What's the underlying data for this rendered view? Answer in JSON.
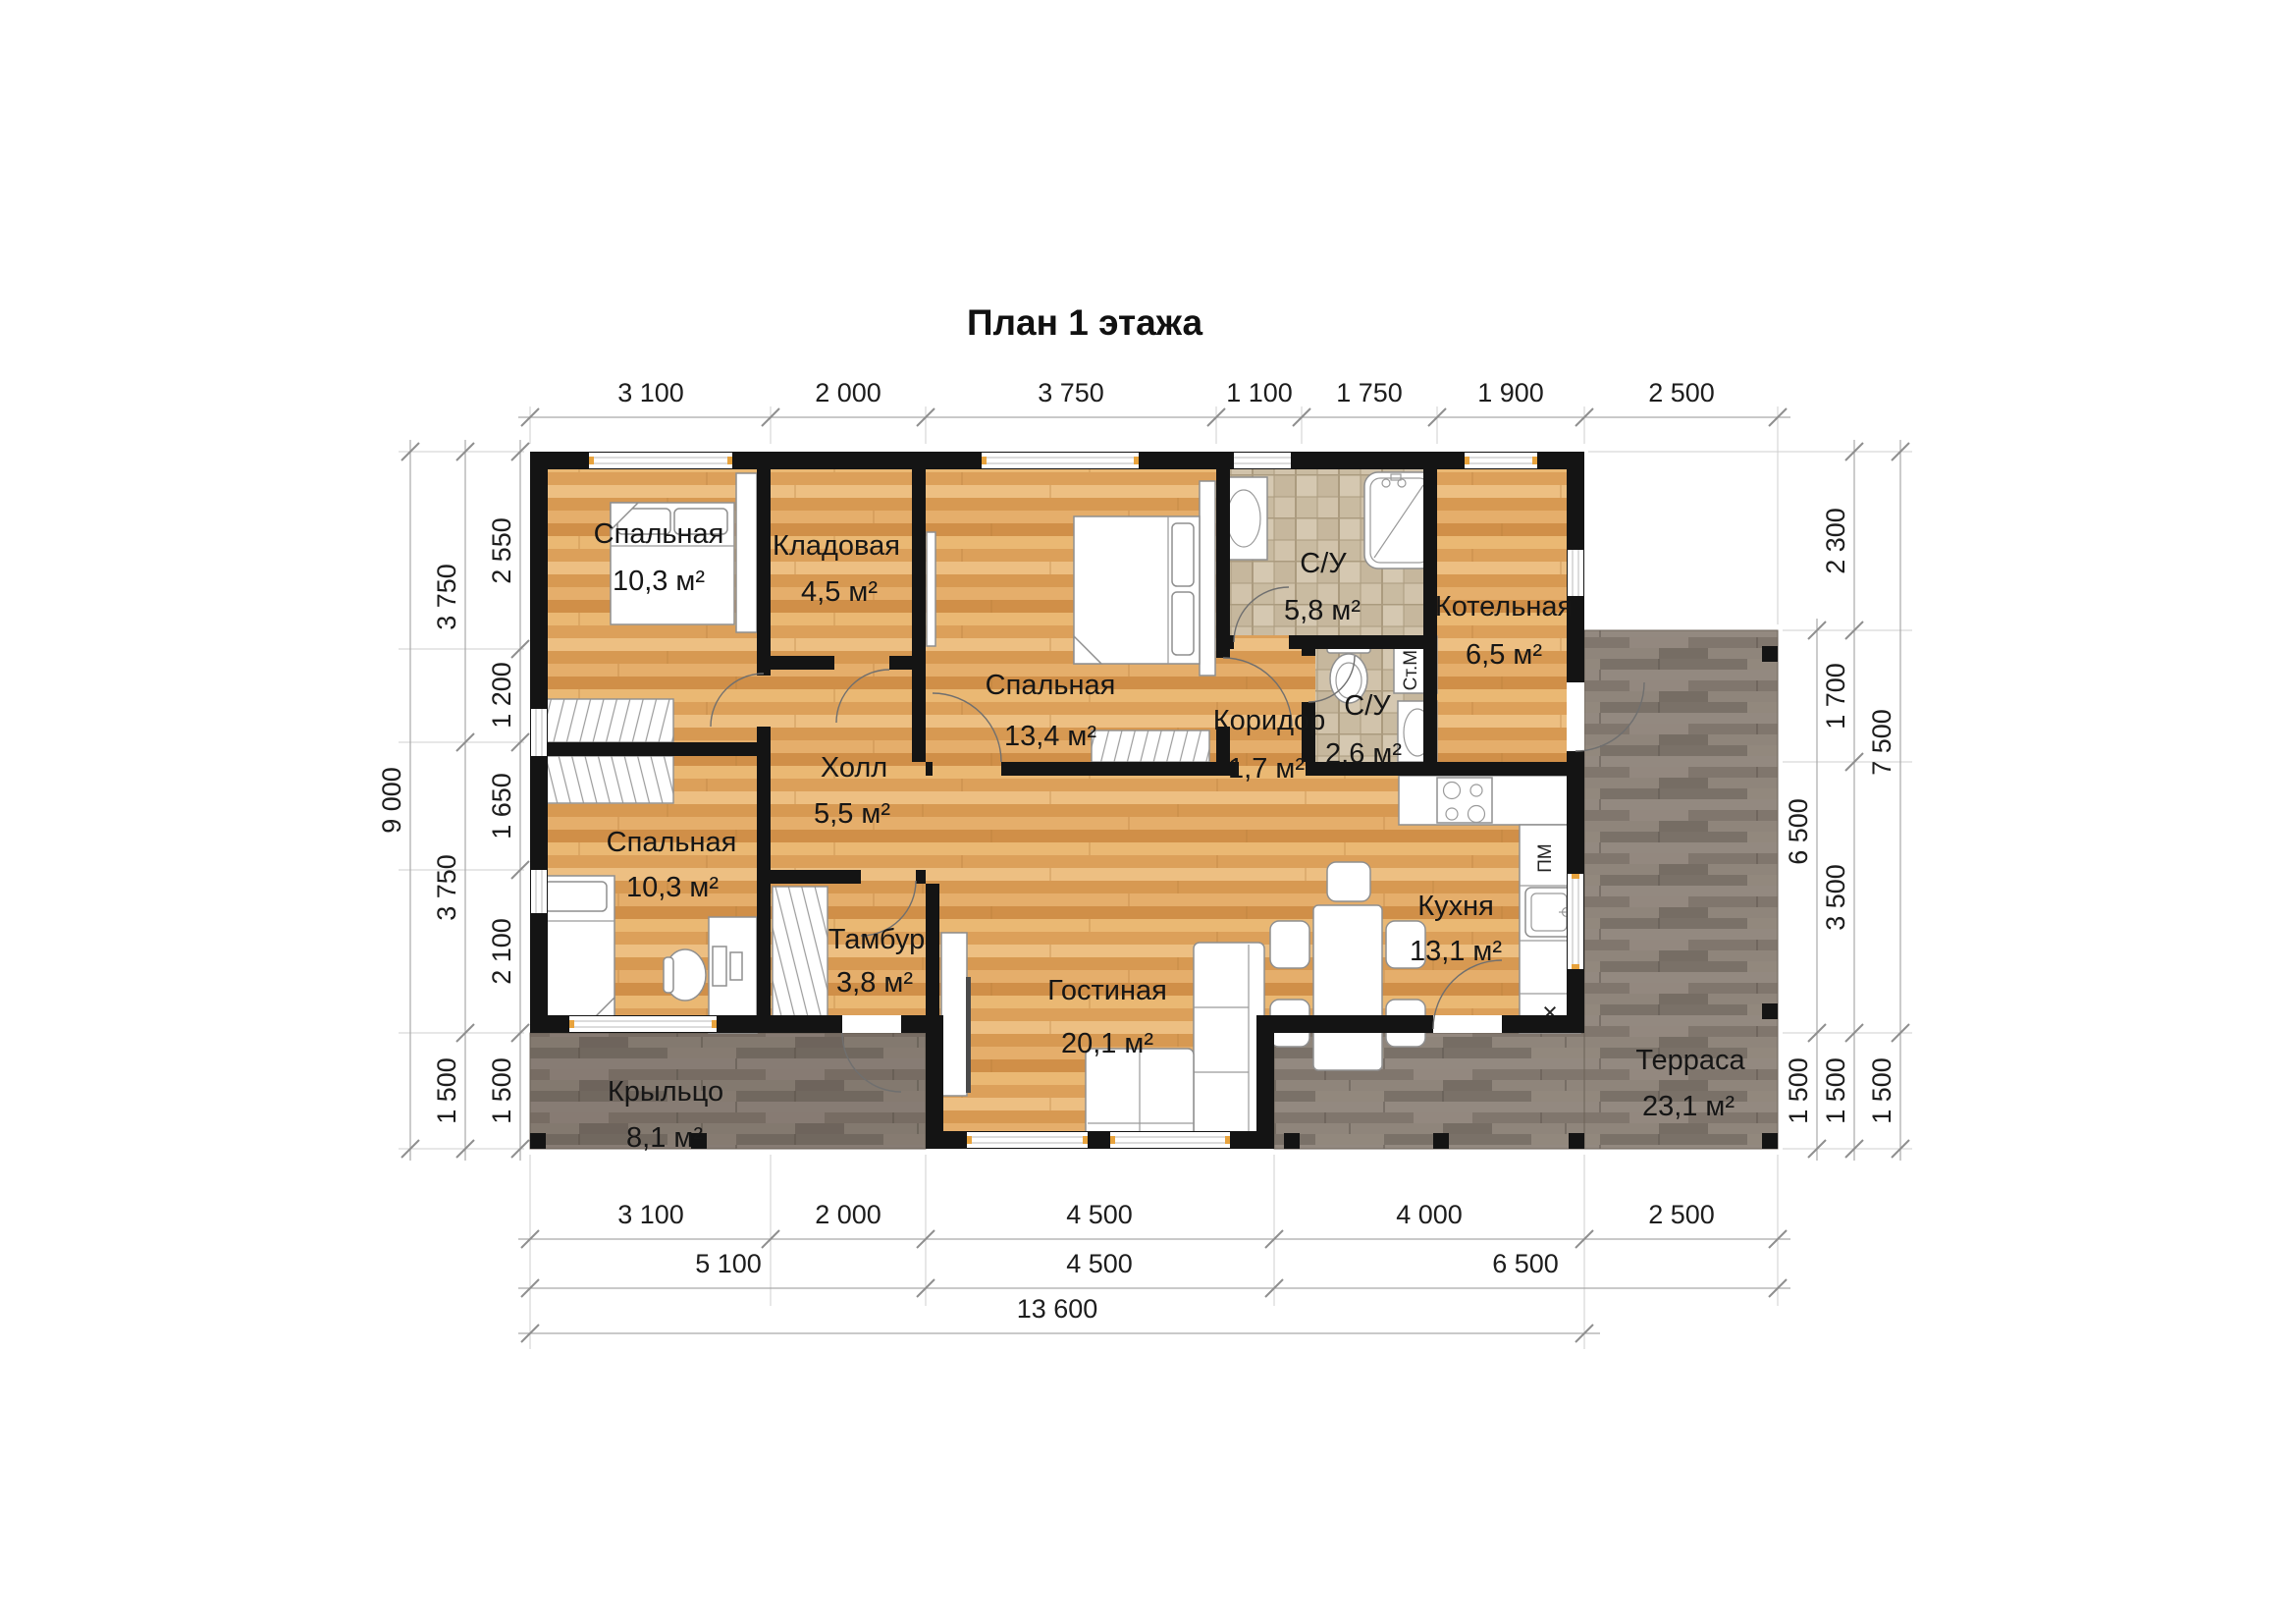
{
  "title": "План 1 этажа",
  "rooms": [
    {
      "name": "Спальная",
      "area": "10,3 м²"
    },
    {
      "name": "Кладовая",
      "area": "4,5 м²"
    },
    {
      "name": "Спальная",
      "area": "13,4 м²"
    },
    {
      "name": "С/У",
      "area": "5,8 м²"
    },
    {
      "name": "Котельная",
      "area": "6,5 м²"
    },
    {
      "name": "Коридор",
      "area": "1,7 м²"
    },
    {
      "name": "С/У",
      "area": "2,6 м²"
    },
    {
      "name": "Холл",
      "area": "5,5 м²"
    },
    {
      "name": "Спальная",
      "area": "10,3 м²"
    },
    {
      "name": "Тамбур",
      "area": "3,8 м²"
    },
    {
      "name": "Гостиная",
      "area": "20,1 м²"
    },
    {
      "name": "Кухня",
      "area": "13,1 м²"
    },
    {
      "name": "Крыльцо",
      "area": "8,1 м²"
    },
    {
      "name": "Терраса",
      "area": "23,1 м²"
    }
  ],
  "appliances": {
    "washing_machine": "Ст.М.",
    "dishwasher": "ПМ",
    "hob_cross": "×"
  },
  "dimensions": {
    "top": [
      "3 100",
      "2 000",
      "3 750",
      "1 100",
      "1 750",
      "1 900",
      "2 500"
    ],
    "left_inner": [
      "2 550",
      "1 200",
      "1 650",
      "2 100",
      "1 500"
    ],
    "left_middle": [
      "3 750",
      "3 750",
      "1 500"
    ],
    "left_outer": [
      "9 000"
    ],
    "right_inner": [
      "6 500",
      "1 500"
    ],
    "right_middle": [
      "2 300",
      "1 700",
      "3 500",
      "1 500"
    ],
    "right_outer": [
      "7 500",
      "1 500"
    ],
    "bottom_first": [
      "3 100",
      "2 000",
      "4 500",
      "4 000",
      "2 500"
    ],
    "bottom_second": [
      "5 100",
      "4 500",
      "6 500"
    ],
    "bottom_third": [
      "13 600"
    ]
  },
  "colors": {
    "wall": "#141414",
    "wood_floor": "#e3aa65",
    "tile_floor": "#cec0a7",
    "deck_floor": "#867c73",
    "dimension_line": "#a9a9a9",
    "window_accent": "#e8a33d"
  }
}
